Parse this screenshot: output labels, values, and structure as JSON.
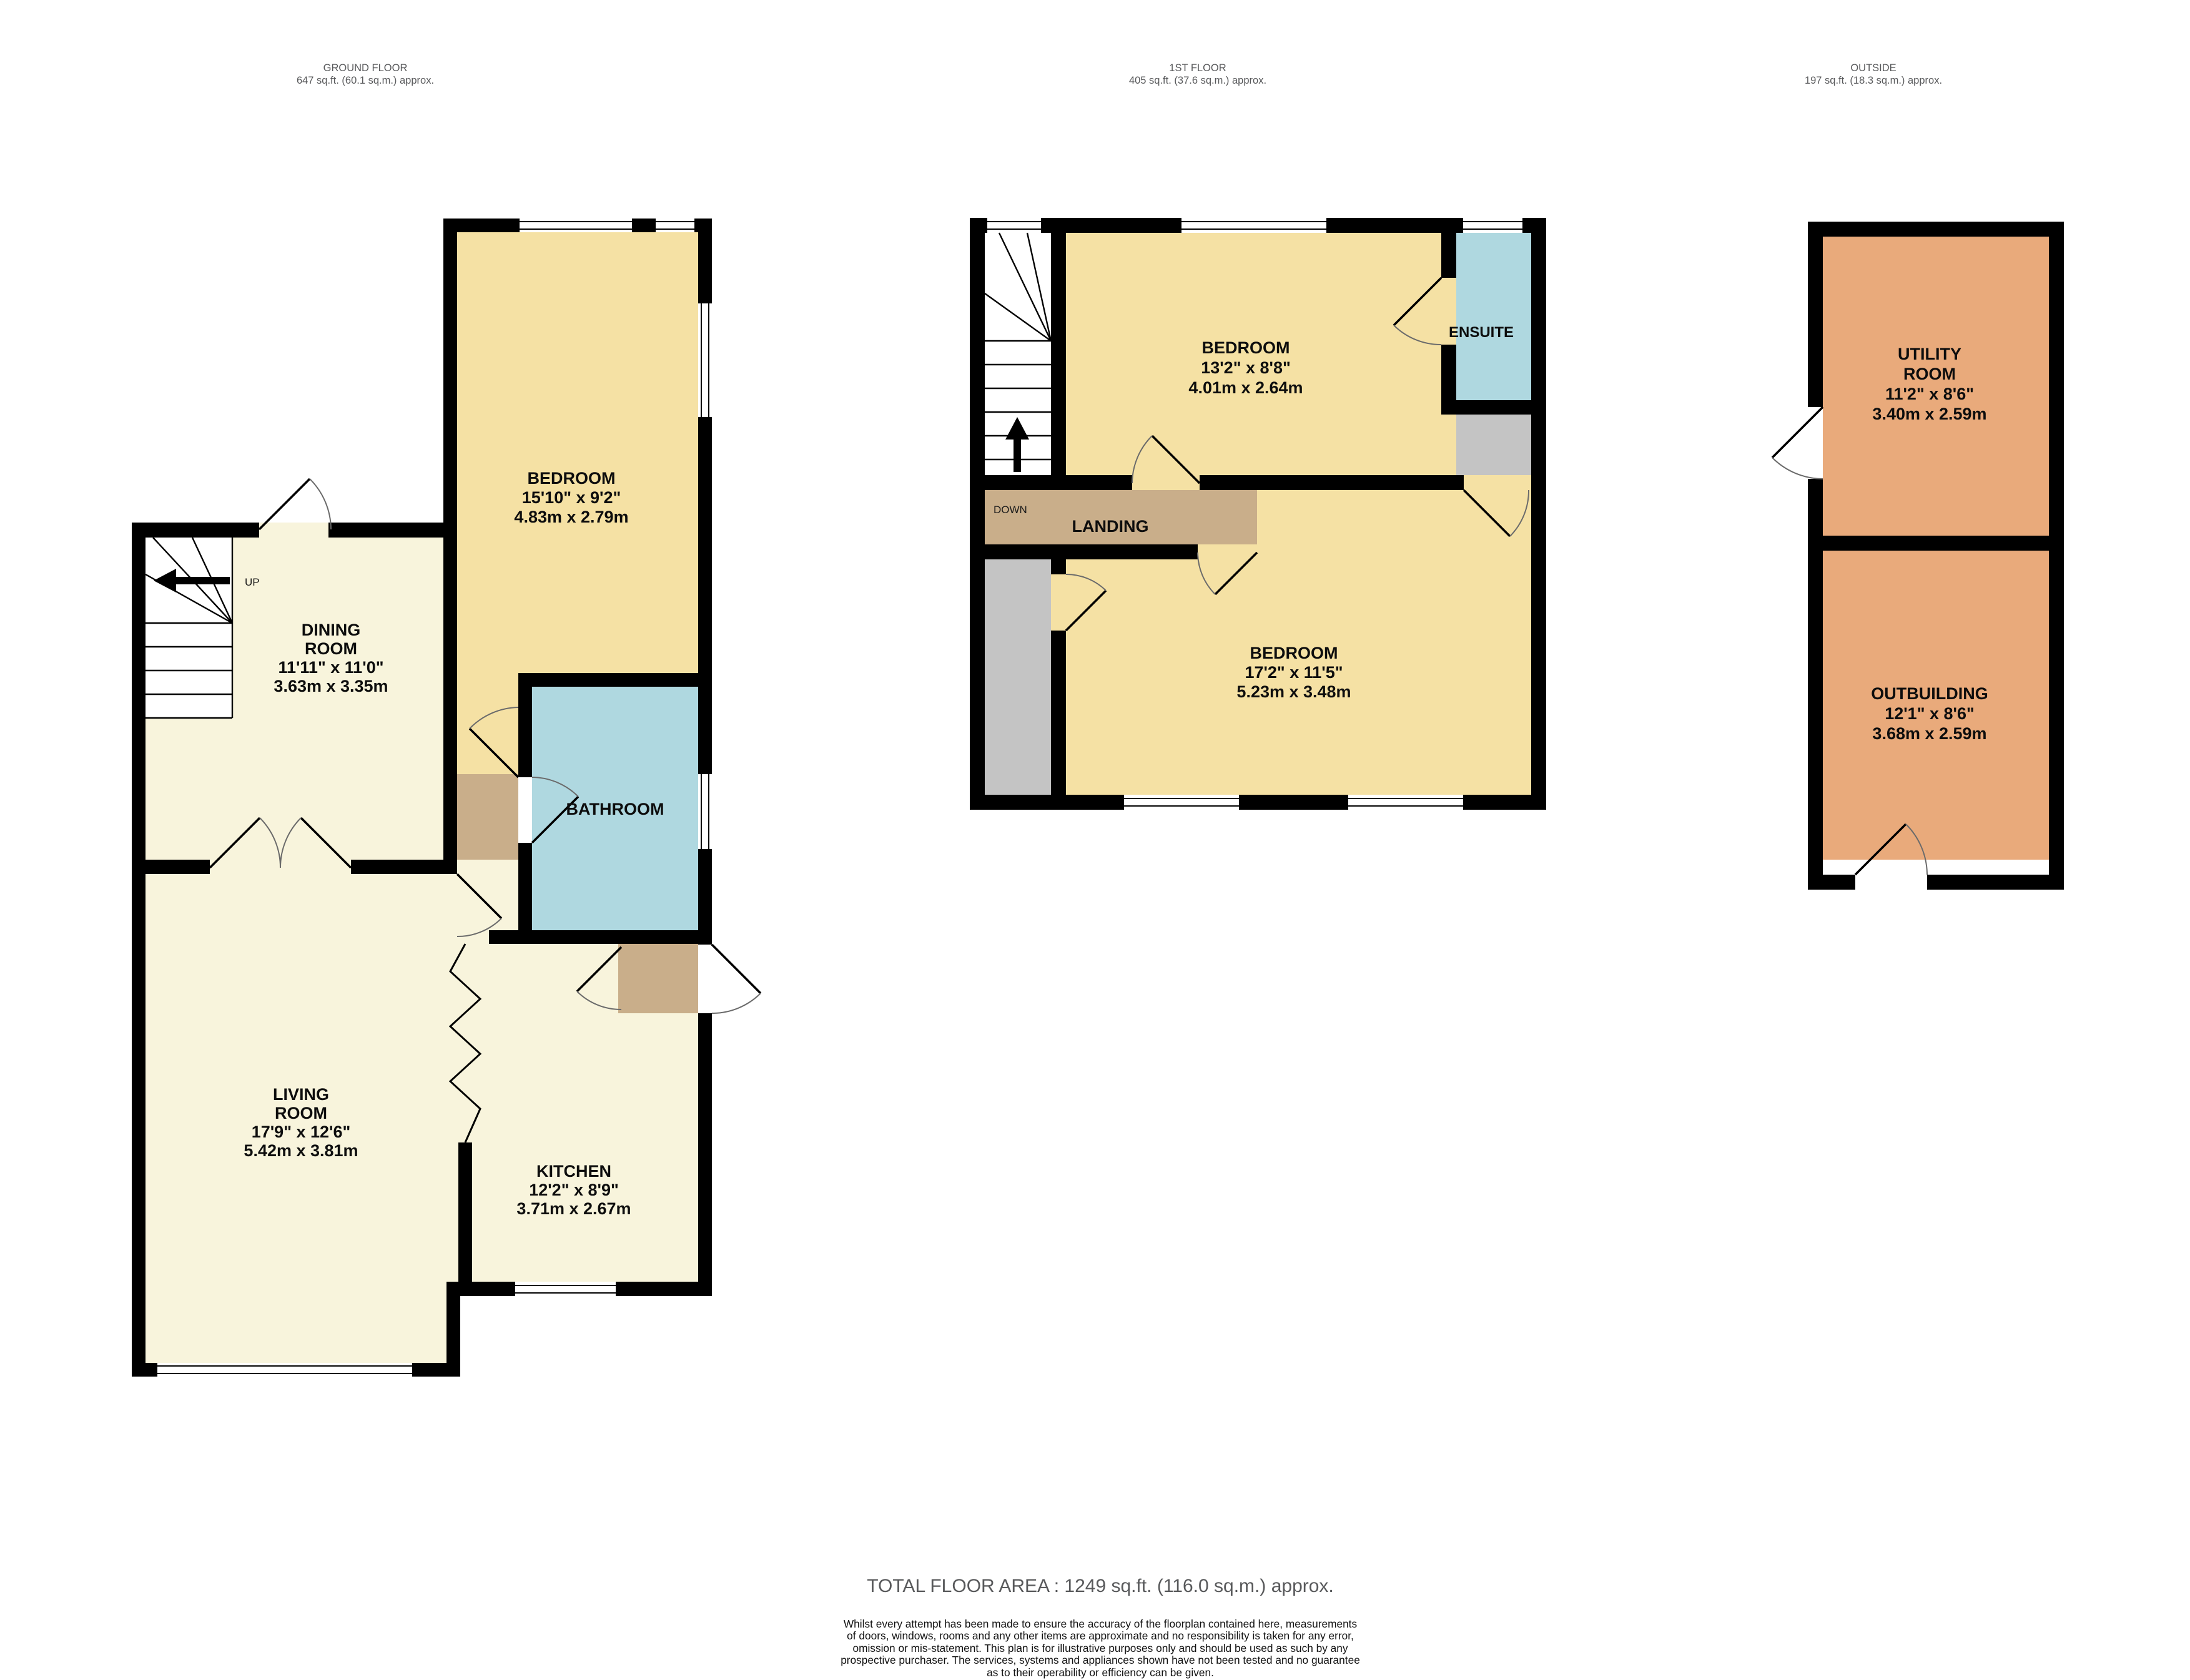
{
  "palette": {
    "wall": "#000000",
    "room_cream": "#F8F4DC",
    "room_yellow": "#F5E1A4",
    "room_blue": "#AFD8E0",
    "room_tan": "#C9AE8A",
    "room_gray": "#C4C4C4",
    "room_orange": "#E9AA7B",
    "header_text": "#58595B"
  },
  "floors": {
    "ground": {
      "title": "GROUND FLOOR",
      "area": "647 sq.ft. (60.1 sq.m.) approx.",
      "stairs_label": "UP",
      "rooms": {
        "bedroom": {
          "name": "BEDROOM",
          "imperial": "15'10\"  x 9'2\"",
          "metric": "4.83m  x 2.79m"
        },
        "dining": {
          "name_line1": "DINING",
          "name_line2": "ROOM",
          "imperial": "11'11\"  x 11'0\"",
          "metric": "3.63m  x 3.35m"
        },
        "bathroom": {
          "name": "BATHROOM"
        },
        "living": {
          "name_line1": "LIVING",
          "name_line2": "ROOM",
          "imperial": "17'9\"  x 12'6\"",
          "metric": "5.42m  x 3.81m"
        },
        "kitchen": {
          "name": "KITCHEN",
          "imperial": "12'2\"  x 8'9\"",
          "metric": "3.71m  x 2.67m"
        }
      }
    },
    "first": {
      "title": "1ST FLOOR",
      "area": "405 sq.ft. (37.6 sq.m.) approx.",
      "stairs_label": "DOWN",
      "rooms": {
        "bedroom_front": {
          "name": "BEDROOM",
          "imperial": "13'2\"  x 8'8\"",
          "metric": "4.01m  x 2.64m"
        },
        "ensuite": {
          "name": "ENSUITE"
        },
        "landing": {
          "name": "LANDING"
        },
        "bedroom_rear": {
          "name": "BEDROOM",
          "imperial": "17'2\"  x 11'5\"",
          "metric": "5.23m  x 3.48m"
        }
      }
    },
    "outside": {
      "title": "OUTSIDE",
      "area": "197 sq.ft. (18.3 sq.m.) approx.",
      "rooms": {
        "utility": {
          "name_line1": "UTILITY",
          "name_line2": "ROOM",
          "imperial": "11'2\"  x 8'6\"",
          "metric": "3.40m  x 2.59m"
        },
        "outbuilding": {
          "name": "OUTBUILDING",
          "imperial": "12'1\"  x 8'6\"",
          "metric": "3.68m  x 2.59m"
        }
      }
    }
  },
  "footer": {
    "total": "TOTAL FLOOR AREA : 1249 sq.ft. (116.0 sq.m.) approx.",
    "disclaimer": [
      "Whilst every attempt has been made to ensure the accuracy of the floorplan contained here, measurements",
      "of doors, windows, rooms and any other items are approximate and no responsibility is taken for any error,",
      "omission or mis-statement. This plan is for illustrative purposes only and should be used as such by any",
      "prospective purchaser. The services, systems and appliances shown have not been tested and no guarantee",
      "as to their operability or efficiency can be given.",
      "Made with Metropix ©2025"
    ]
  }
}
